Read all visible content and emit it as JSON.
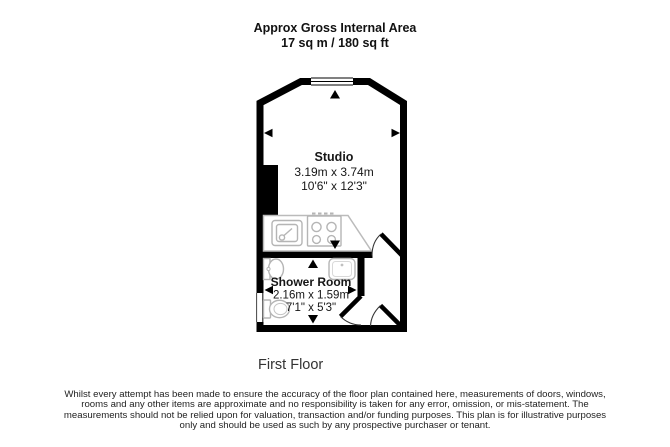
{
  "header": {
    "line1": "Approx Gross Internal Area",
    "line2": "17 sq m / 180 sq ft"
  },
  "floorplan": {
    "rooms": [
      {
        "name": "Studio",
        "metric": "3.19m x 3.74m",
        "imperial": "10'6\" x 12'3\""
      },
      {
        "name": "Shower Room",
        "metric": "2.16m x 1.59m",
        "imperial": "7'1\" x 5'3\""
      }
    ],
    "fixtures": [
      "kitchen-sink",
      "hob",
      "shower-enclosure",
      "basin",
      "toilet"
    ],
    "windows": 2,
    "doors": 3,
    "colors": {
      "wall": "#000000",
      "fixture_outline": "#b5b5b5",
      "text": "#1a1a1a"
    }
  },
  "floor_label": "First Floor",
  "disclaimer": "Whilst every attempt has been made to ensure the accuracy of the floor plan contained here, measurements of doors, windows, rooms and any other items are approximate and no responsibility is taken for any error, omission, or mis-statement. The measurements should not be relied upon for valuation, transaction and/or funding purposes. This plan is for illustrative purposes only and should be used as such by any prospective purchaser or tenant."
}
